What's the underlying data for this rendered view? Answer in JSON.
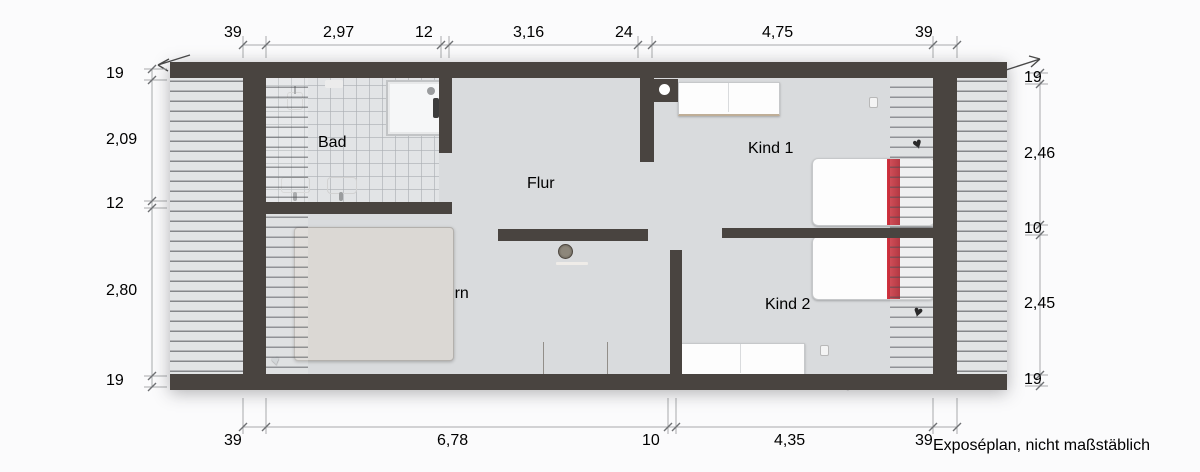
{
  "plan": {
    "rooms": [
      {
        "id": "bad",
        "label": "Bad"
      },
      {
        "id": "flur",
        "label": "Flur"
      },
      {
        "id": "eltern",
        "label": "Eltern"
      },
      {
        "id": "kind1",
        "label": "Kind 1"
      },
      {
        "id": "kind2",
        "label": "Kind 2"
      }
    ],
    "watermark": "illustration©immoGrafik",
    "footnote": "Exposéplan, nicht maßstäblich"
  },
  "dimensions": {
    "top": [
      "39",
      "2,97",
      "12",
      "3,16",
      "24",
      "4,75",
      "39"
    ],
    "bottom": [
      "39",
      "6,78",
      "10",
      "4,35",
      "39"
    ],
    "left": [
      "19",
      "2,09",
      "12",
      "2,80",
      "19"
    ],
    "right": [
      "19",
      "2,46",
      "10",
      "2,45",
      "19"
    ]
  },
  "colors": {
    "wall": "#494440",
    "floor": "#d9dbdd",
    "tile": "#e2e4e6",
    "accent_red": "#c0202c",
    "wood": "#a88e6f",
    "dimension_text": "#6f7276"
  }
}
